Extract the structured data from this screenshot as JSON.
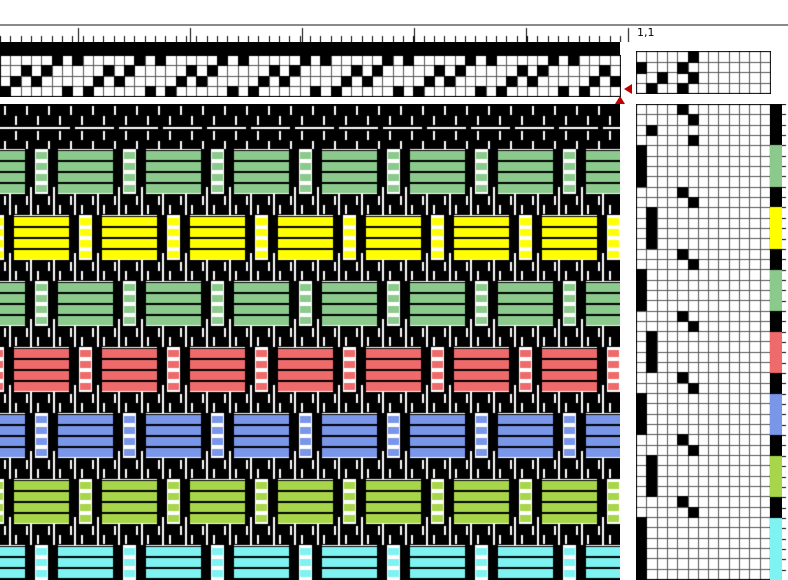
{
  "header": {
    "position_label": "1,1"
  },
  "palette": {
    "warp": "#000000",
    "black": "#000000",
    "green": "#8cc98c",
    "yellow": "#ffff00",
    "red": "#ef6b6b",
    "blue": "#7a96e8",
    "lime": "#a8d64a",
    "cyan": "#7ff2f2",
    "marker": "#c00000",
    "grid_line": "#555555",
    "grid_border": "#000000"
  },
  "ruler": {
    "minor_tick_spacing": 10.333,
    "major_tick_start": 78,
    "major_tick_spacing": 112,
    "end_tick_x": 628
  },
  "threading": {
    "cols": 60,
    "rows": 4,
    "cells": {
      "row1": [
        6,
        8,
        14,
        16,
        22,
        24,
        30,
        32,
        38,
        40,
        46,
        48,
        54,
        56
      ],
      "row2": [
        3,
        5,
        11,
        13,
        19,
        21,
        27,
        29,
        35,
        37,
        43,
        45,
        51,
        53,
        59
      ],
      "row3": [
        2,
        4,
        10,
        12,
        18,
        20,
        26,
        28,
        34,
        36,
        42,
        44,
        50,
        52,
        58,
        60
      ],
      "row4": [
        1,
        7,
        9,
        15,
        17,
        23,
        25,
        31,
        33,
        39,
        41,
        47,
        49,
        55,
        57
      ]
    }
  },
  "tieup": {
    "cols": 13,
    "rows": 4,
    "cells": [
      [
        6
      ],
      [
        1,
        5
      ],
      [
        3,
        6
      ],
      [
        2,
        5
      ]
    ]
  },
  "liftplan": {
    "cols": 13,
    "rows": [
      {
        "col": 5,
        "weft": "black"
      },
      {
        "col": 6,
        "weft": "black"
      },
      {
        "col": 2,
        "weft": "black"
      },
      {
        "col": 6,
        "weft": "black"
      },
      {
        "col": 1,
        "weft": "green"
      },
      {
        "col": 1,
        "weft": "green"
      },
      {
        "col": 1,
        "weft": "green"
      },
      {
        "col": 1,
        "weft": "green"
      },
      {
        "col": 5,
        "weft": "black"
      },
      {
        "col": 6,
        "weft": "black"
      },
      {
        "col": 2,
        "weft": "yellow"
      },
      {
        "col": 2,
        "weft": "yellow"
      },
      {
        "col": 2,
        "weft": "yellow"
      },
      {
        "col": 2,
        "weft": "yellow"
      },
      {
        "col": 5,
        "weft": "black"
      },
      {
        "col": 6,
        "weft": "black"
      },
      {
        "col": 1,
        "weft": "green"
      },
      {
        "col": 1,
        "weft": "green"
      },
      {
        "col": 1,
        "weft": "green"
      },
      {
        "col": 1,
        "weft": "green"
      },
      {
        "col": 5,
        "weft": "black"
      },
      {
        "col": 6,
        "weft": "black"
      },
      {
        "col": 2,
        "weft": "red"
      },
      {
        "col": 2,
        "weft": "red"
      },
      {
        "col": 2,
        "weft": "red"
      },
      {
        "col": 2,
        "weft": "red"
      },
      {
        "col": 5,
        "weft": "black"
      },
      {
        "col": 6,
        "weft": "black"
      },
      {
        "col": 1,
        "weft": "blue"
      },
      {
        "col": 1,
        "weft": "blue"
      },
      {
        "col": 1,
        "weft": "blue"
      },
      {
        "col": 1,
        "weft": "blue"
      },
      {
        "col": 5,
        "weft": "black"
      },
      {
        "col": 6,
        "weft": "black"
      },
      {
        "col": 2,
        "weft": "lime"
      },
      {
        "col": 2,
        "weft": "lime"
      },
      {
        "col": 2,
        "weft": "lime"
      },
      {
        "col": 2,
        "weft": "lime"
      },
      {
        "col": 5,
        "weft": "black"
      },
      {
        "col": 6,
        "weft": "black"
      },
      {
        "col": 1,
        "weft": "cyan"
      },
      {
        "col": 1,
        "weft": "cyan"
      },
      {
        "col": 1,
        "weft": "cyan"
      },
      {
        "col": 1,
        "weft": "cyan"
      },
      {
        "col": 1,
        "weft": "cyan"
      },
      {
        "col": 1,
        "weft": "cyan"
      }
    ]
  },
  "drawdown": {
    "bands": [
      {
        "kind": "hem",
        "color": "black"
      },
      {
        "kind": "color",
        "color": "green",
        "phase": "A"
      },
      {
        "kind": "color",
        "color": "yellow",
        "phase": "B"
      },
      {
        "kind": "color",
        "color": "green",
        "phase": "A"
      },
      {
        "kind": "color",
        "color": "red",
        "phase": "B"
      },
      {
        "kind": "color",
        "color": "blue",
        "phase": "A"
      },
      {
        "kind": "color",
        "color": "lime",
        "phase": "B"
      },
      {
        "kind": "color",
        "color": "cyan",
        "phase": "A"
      }
    ],
    "geometry": {
      "width": 620,
      "height": 476,
      "period": 88,
      "bar_offsets": [
        25,
        48
      ],
      "bar_width": 10,
      "narrow_x": 35,
      "narrow_w": 13,
      "phase_b_shift": 44,
      "hem_h": 45,
      "band_h": 45,
      "sep_h": 21,
      "stripe_step": 11,
      "dash_spacing": 22,
      "dash_h": 9
    }
  }
}
